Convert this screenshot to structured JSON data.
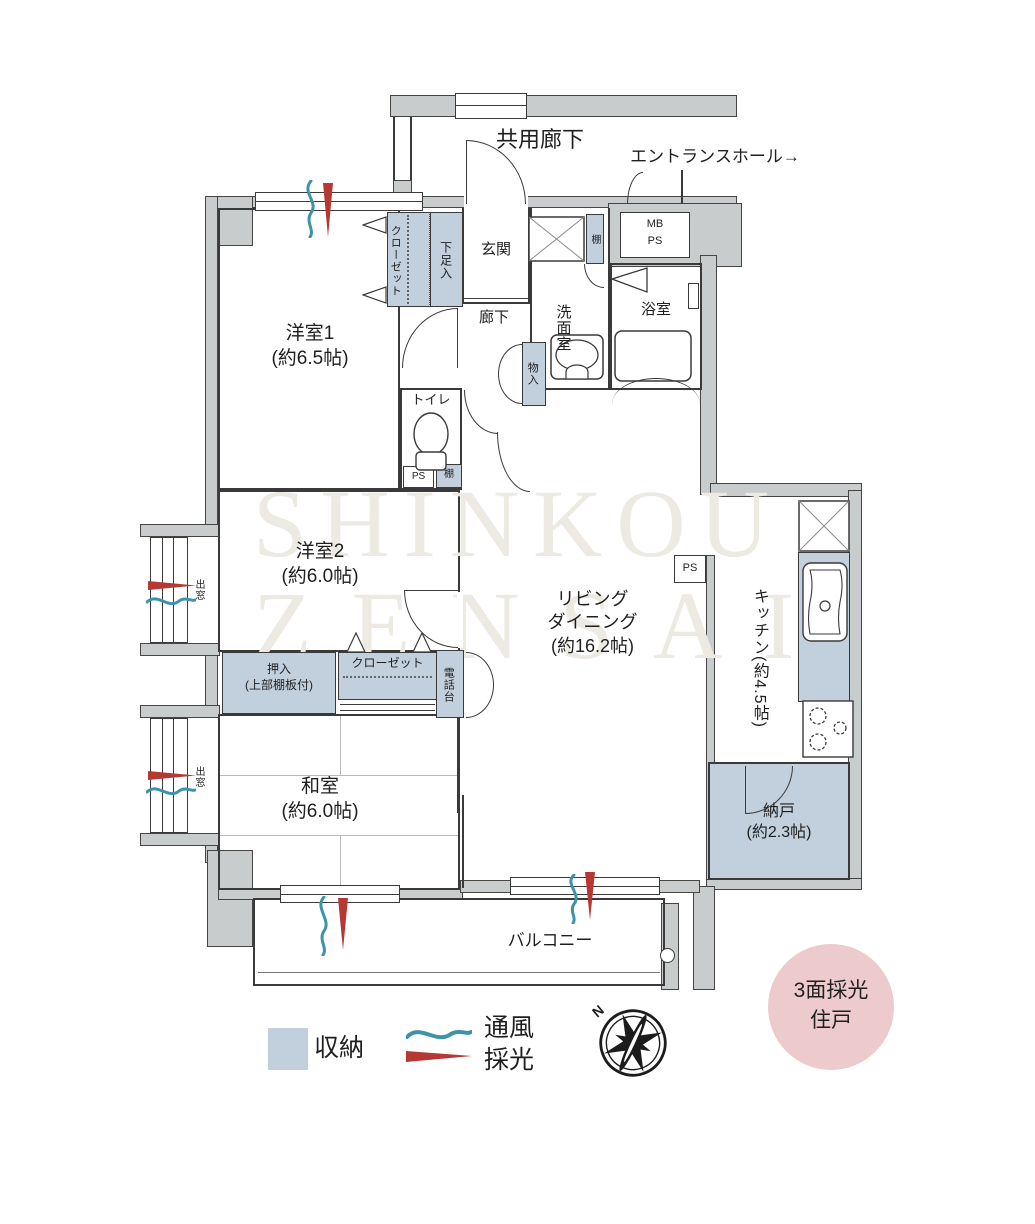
{
  "header": {
    "corridor": "共用廊下",
    "entrance_hall": "エントランスホール→"
  },
  "rooms": {
    "western1": "洋室1\n(約6.5帖)",
    "western2": "洋室2\n(約6.0帖)",
    "japanese": "和室\n(約6.0帖)",
    "living_dining": "リビング\nダイニング\n(約16.2帖)",
    "kitchen": "キッチン(約4.5帖)",
    "storeroom": "納戸\n(約2.3帖)",
    "entrance": "玄関",
    "hallway": "廊下",
    "washroom": "洗面室",
    "bathroom": "浴室",
    "toilet": "トイレ",
    "balcony": "バルコニー"
  },
  "storage": {
    "closet": "クローゼット",
    "shoe_box": "下足入",
    "shelf": "棚",
    "monoire": "物入",
    "oshiire": "押入\n(上部棚板付)",
    "phone_stand": "電話台",
    "bay_window": "出窓"
  },
  "utility": {
    "mb_ps": "MB\nPS",
    "ps": "PS"
  },
  "legend": {
    "storage": "収納",
    "ventilation": "通風",
    "daylight": "採光"
  },
  "badge": "3面採光\n住戸",
  "compass": {
    "north": "N"
  },
  "watermark": {
    "line1": "SHINKOU",
    "line2": "ZENSAI"
  },
  "colors": {
    "wall": "#c8cccd",
    "storage_fill": "#c2cfdd",
    "badge_fill": "#edcacb",
    "ventilation": "#3f93a9",
    "daylight": "#b53832"
  }
}
